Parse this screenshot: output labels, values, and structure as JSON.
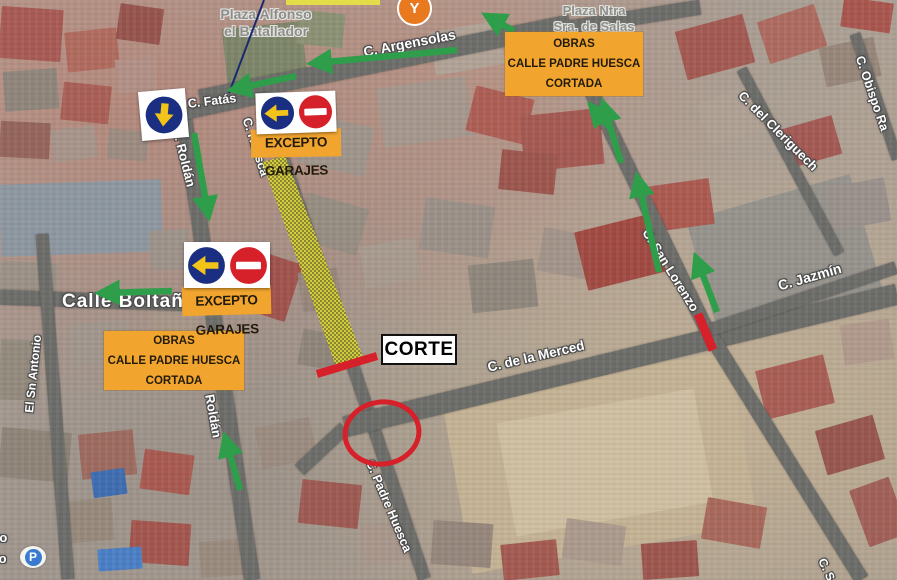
{
  "street_labels": [
    {
      "id": "plaza-alfonso",
      "text": "Plaza Alfonso\nel Batallador"
    },
    {
      "id": "plaza-salas",
      "text": "Plaza Ntra\nSra. de Salas"
    },
    {
      "id": "argensolas",
      "text": "C. Argensolas"
    },
    {
      "id": "fatas",
      "text": "C. Fatás"
    },
    {
      "id": "roldan-upper",
      "text": "C. Roldán"
    },
    {
      "id": "roldan-lower",
      "text": "Roldán"
    },
    {
      "id": "huesca",
      "text": "C. Huesca"
    },
    {
      "id": "boltana",
      "text": "Calle Boltaña"
    },
    {
      "id": "merced",
      "text": "C. de la Merced"
    },
    {
      "id": "san-lorenzo",
      "text": "C. San Lorenzo"
    },
    {
      "id": "jazmin",
      "text": "C. Jazmín"
    },
    {
      "id": "cleriguech",
      "text": "C. del Cleriguech"
    },
    {
      "id": "obispo",
      "text": "C. Obispo Ra"
    },
    {
      "id": "san-antonio",
      "text": "El Sn Antonio"
    },
    {
      "id": "padre-huesca",
      "text": "C. Padre Huesca"
    },
    {
      "id": "cs-fragment",
      "text": "C. S"
    },
    {
      "id": "edge-fragment-to",
      "text": "to"
    },
    {
      "id": "edge-fragment-io",
      "text": "io"
    }
  ],
  "boxes": {
    "obras_right": {
      "text": "OBRAS\nCALLE PADRE HUESCA\nCORTADA"
    },
    "obras_left": {
      "text": "OBRAS\nCALLE PADRE HUESCA\nCORTADA"
    },
    "excepto_top": {
      "text": "EXCEPTO GARAJES"
    },
    "excepto_left": {
      "text": "EXCEPTO GARAJES"
    },
    "corte": {
      "text": "CORTE"
    }
  },
  "icons": {
    "parking_letter": "P",
    "pin_glyph": "Y",
    "no_entry": "no-entry-sign",
    "arrow_left": "blue-left-arrow-sign",
    "arrow_down": "blue-down-arrow-sign"
  },
  "colors": {
    "annotation_orange": "#F2A52E",
    "closure_red": "#D6202A",
    "direction_green": "#2F9E4A",
    "sign_navy": "#1B2F82",
    "sign_arrow_yellow": "#F2C318",
    "closed_strip_yellow": "#D8D23C"
  }
}
